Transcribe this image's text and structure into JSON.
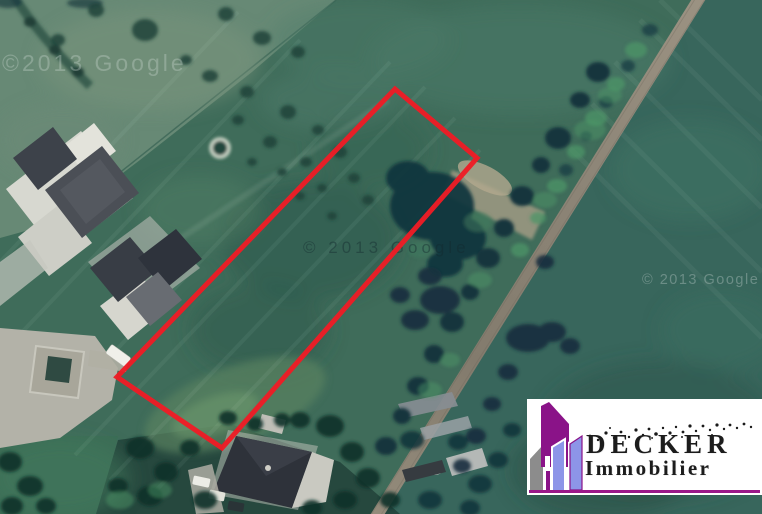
{
  "image": {
    "width": 762,
    "height": 514,
    "kind": "satellite aerial photo with property boundary overlay"
  },
  "colors": {
    "boundary_red": "#ee1c25",
    "logo_purple": "#8a1388",
    "logo_periwinkle": "#8d95e8",
    "logo_gray": "#8c8c8c",
    "underline_magenta": "#9b1889",
    "field_green": "#3f6c5a",
    "road_tan": "#8d8577"
  },
  "boundary": {
    "points": "395,89 477,158 222,448 117,377",
    "stroke_width": 5
  },
  "watermarks": {
    "top_left": "©2013 Google",
    "center": "© 2013 Google",
    "bottom_right": "© 2013 Google"
  },
  "logo": {
    "brand": "DECKER",
    "tagline": "Immobilier"
  }
}
